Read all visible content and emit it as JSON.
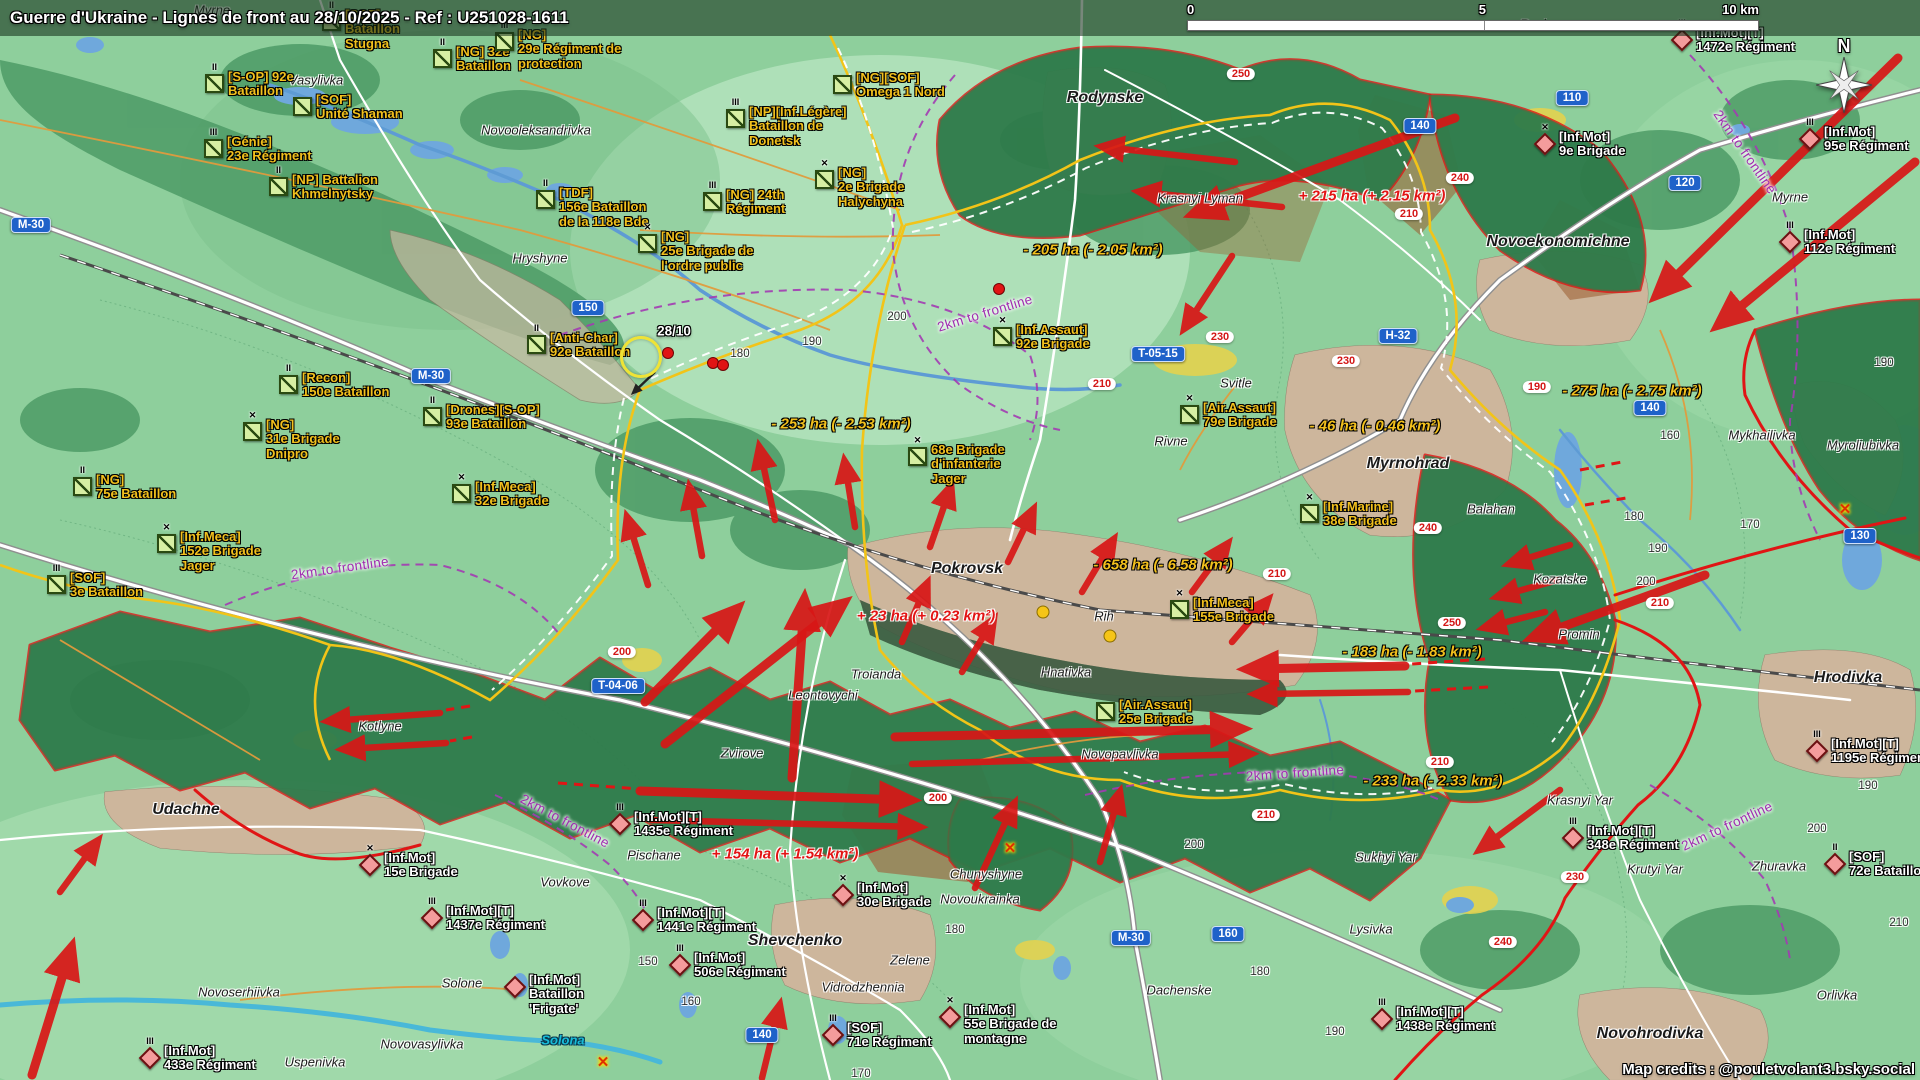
{
  "header": {
    "title": "Guerre d'Ukraine - Lignes de front au 28/10/2025 - Ref : U251028-1611"
  },
  "scalebar": {
    "t0": "0",
    "t5": "5",
    "t10": "10 km"
  },
  "compass": "N",
  "credits": "Map credits : @pouletvolant3.bsky.social",
  "colors": {
    "ua_label": "#f2c01d",
    "ru_label": "#ffffff",
    "front_red": "#e01515",
    "claim_yellow": "#f2c418",
    "shield_blue": "#1f62c9",
    "route_red": "#d31616",
    "frontline_note": "#a02bb0",
    "water": "#6fa8dc",
    "ru_zone": "#2e7a4a",
    "urban": "#cdb69c",
    "gain": "#e21414",
    "loss": "#f2c01d"
  },
  "date_marker": {
    "x": 674,
    "y": 331,
    "text": "28/10"
  },
  "ua_units": [
    {
      "x": 322,
      "y": 8,
      "ech": "II",
      "lines": [
        "[SOF]",
        "Bataillon",
        "Stugna"
      ]
    },
    {
      "x": 205,
      "y": 70,
      "ech": "II",
      "lines": [
        "[S-OP] 92e",
        "Bataillon"
      ]
    },
    {
      "x": 293,
      "y": 93,
      "ech": "",
      "lines": [
        "[SOF]",
        "Unité Shaman"
      ]
    },
    {
      "x": 204,
      "y": 135,
      "ech": "III",
      "lines": [
        "[Génie]",
        "23e Régiment"
      ]
    },
    {
      "x": 269,
      "y": 173,
      "ech": "II",
      "lines": [
        "[NP] Battalion",
        "Khmelnytsky"
      ]
    },
    {
      "x": 433,
      "y": 45,
      "ech": "II",
      "lines": [
        "[NG] 32e",
        "Bataillon"
      ]
    },
    {
      "x": 495,
      "y": 28,
      "ech": "III",
      "lines": [
        "[NG]",
        "29e Régiment de",
        "protection"
      ]
    },
    {
      "x": 833,
      "y": 71,
      "ech": "",
      "lines": [
        "[NG][SOF]",
        "Omega 1 Nord"
      ]
    },
    {
      "x": 726,
      "y": 105,
      "ech": "III",
      "lines": [
        "[NP][Inf.Légère]",
        "Bataillon de",
        "Donetsk"
      ]
    },
    {
      "x": 536,
      "y": 186,
      "ech": "II",
      "lines": [
        "[TDF]",
        "156e Bataillon",
        "de la 118e Bde"
      ]
    },
    {
      "x": 703,
      "y": 188,
      "ech": "III",
      "lines": [
        "[NG] 24th",
        "Régiment"
      ]
    },
    {
      "x": 815,
      "y": 166,
      "ech": "✕",
      "lines": [
        "[NG]",
        "2e Brigade",
        "Halychyna"
      ]
    },
    {
      "x": 638,
      "y": 230,
      "ech": "✕",
      "lines": [
        "[NG]",
        "25e Brigade de",
        "l'ordre public"
      ]
    },
    {
      "x": 527,
      "y": 331,
      "ech": "II",
      "lines": [
        "[Anti-Char]",
        "92e Bataillon"
      ]
    },
    {
      "x": 279,
      "y": 371,
      "ech": "II",
      "lines": [
        "[Recon]",
        "150e Bataillon"
      ]
    },
    {
      "x": 423,
      "y": 403,
      "ech": "II",
      "lines": [
        "[Drones][S-OP]",
        "93e Bataillon"
      ]
    },
    {
      "x": 243,
      "y": 418,
      "ech": "✕",
      "lines": [
        "[NG]",
        "31e Brigade",
        "Dnipro"
      ]
    },
    {
      "x": 73,
      "y": 473,
      "ech": "II",
      "lines": [
        "[NG]",
        "75e Bataillon"
      ]
    },
    {
      "x": 157,
      "y": 530,
      "ech": "✕",
      "lines": [
        "[Inf.Meca]",
        "152e Brigade",
        "Jager"
      ]
    },
    {
      "x": 47,
      "y": 571,
      "ech": "III",
      "lines": [
        "[SOF]",
        "3e Bataillon"
      ]
    },
    {
      "x": 452,
      "y": 480,
      "ech": "✕",
      "lines": [
        "[Inf.Meca]",
        "32e Brigade"
      ]
    },
    {
      "x": 993,
      "y": 323,
      "ech": "✕",
      "lines": [
        "[Inf.Assaut]",
        "92e Brigade"
      ]
    },
    {
      "x": 1180,
      "y": 401,
      "ech": "✕",
      "lines": [
        "[Air.Assaut]",
        "79e Brigade"
      ]
    },
    {
      "x": 908,
      "y": 443,
      "ech": "✕",
      "lines": [
        "68e Brigade",
        "d'infanterie",
        "Jager"
      ]
    },
    {
      "x": 1170,
      "y": 596,
      "ech": "✕",
      "lines": [
        "[Inf.Meca]",
        "155e Brigade"
      ]
    },
    {
      "x": 1300,
      "y": 500,
      "ech": "✕",
      "lines": [
        "[Inf.Marine]",
        "38e Brigade"
      ]
    },
    {
      "x": 1096,
      "y": 698,
      "ech": "",
      "lines": [
        "[Air.Assaut]",
        "25e Brigade"
      ]
    }
  ],
  "ru_units": [
    {
      "x": 1672,
      "y": 26,
      "ech": "III",
      "lines": [
        "[Inf.Mot][T]",
        "1472e Régiment"
      ]
    },
    {
      "x": 1535,
      "y": 130,
      "ech": "✕",
      "lines": [
        "[Inf.Mot]",
        "9e Brigade"
      ]
    },
    {
      "x": 1800,
      "y": 125,
      "ech": "III",
      "lines": [
        "[Inf.Mot]",
        "95e Régiment"
      ]
    },
    {
      "x": 1780,
      "y": 228,
      "ech": "III",
      "lines": [
        "[Inf.Mot]",
        "112e Régiment"
      ]
    },
    {
      "x": 1807,
      "y": 737,
      "ech": "III",
      "lines": [
        "[Inf.Mot][T]",
        "1195e Régiment"
      ]
    },
    {
      "x": 1563,
      "y": 824,
      "ech": "III",
      "lines": [
        "[Inf.Mot][T]",
        "348e Régiment"
      ]
    },
    {
      "x": 1825,
      "y": 850,
      "ech": "II",
      "lines": [
        "[SOF]",
        "72e Bataillon"
      ]
    },
    {
      "x": 1372,
      "y": 1005,
      "ech": "III",
      "lines": [
        "[Inf.Mot][T]",
        "1438e Régiment"
      ]
    },
    {
      "x": 610,
      "y": 810,
      "ech": "III",
      "lines": [
        "[Inf.Mot][T]",
        "1435e Régiment"
      ]
    },
    {
      "x": 360,
      "y": 851,
      "ech": "✕",
      "lines": [
        "[Inf.Mot]",
        "15e Brigade"
      ]
    },
    {
      "x": 422,
      "y": 904,
      "ech": "III",
      "lines": [
        "[Inf.Mot][T]",
        "1437e Régiment"
      ]
    },
    {
      "x": 633,
      "y": 906,
      "ech": "III",
      "lines": [
        "[Inf.Mot][T]",
        "1441e Régiment"
      ]
    },
    {
      "x": 505,
      "y": 973,
      "ech": "",
      "lines": [
        "[Inf.Mot]",
        "Bataillon",
        "'Frigate'"
      ]
    },
    {
      "x": 670,
      "y": 951,
      "ech": "III",
      "lines": [
        "[Inf.Mot]",
        "506e Régiment"
      ]
    },
    {
      "x": 833,
      "y": 881,
      "ech": "✕",
      "lines": [
        "[Inf.Mot]",
        "30e Brigade"
      ]
    },
    {
      "x": 940,
      "y": 1003,
      "ech": "✕",
      "lines": [
        "[Inf.Mot]",
        "55e Brigade de",
        "montagne"
      ]
    },
    {
      "x": 823,
      "y": 1021,
      "ech": "III",
      "lines": [
        "[SOF]",
        "71e Régiment"
      ]
    },
    {
      "x": 140,
      "y": 1044,
      "ech": "III",
      "lines": [
        "[Inf.Mot]",
        "433e Régiment"
      ]
    }
  ],
  "places": [
    {
      "x": 212,
      "y": 10,
      "text": "Myrne"
    },
    {
      "x": 316,
      "y": 80,
      "text": "Vasylivka"
    },
    {
      "x": 536,
      "y": 130,
      "text": "Novooleksandrivka"
    },
    {
      "x": 540,
      "y": 258,
      "text": "Hryshyne"
    },
    {
      "x": 1105,
      "y": 98,
      "cls": "city",
      "text": "Rodynske"
    },
    {
      "x": 1200,
      "y": 198,
      "text": "Krasnyi Lyman"
    },
    {
      "x": 1540,
      "y": 24,
      "text": "Razine"
    },
    {
      "x": 1558,
      "y": 242,
      "cls": "city",
      "text": "Novoekonomichne"
    },
    {
      "x": 1790,
      "y": 197,
      "text": "Myrne"
    },
    {
      "x": 1236,
      "y": 383,
      "text": "Svitle"
    },
    {
      "x": 1171,
      "y": 441,
      "text": "Rivne"
    },
    {
      "x": 1408,
      "y": 464,
      "cls": "city",
      "text": "Myrnohrad"
    },
    {
      "x": 1491,
      "y": 509,
      "text": "Balahan"
    },
    {
      "x": 1762,
      "y": 435,
      "text": "Mykhailivka"
    },
    {
      "x": 1863,
      "y": 445,
      "text": "Myroliubivka"
    },
    {
      "x": 1560,
      "y": 579,
      "text": "Kozatske"
    },
    {
      "x": 1579,
      "y": 634,
      "text": "Promin"
    },
    {
      "x": 1848,
      "y": 678,
      "cls": "city",
      "text": "Hrodivka"
    },
    {
      "x": 1580,
      "y": 800,
      "text": "Krasnyi Yar"
    },
    {
      "x": 1386,
      "y": 857,
      "text": "Sukhyi Yar"
    },
    {
      "x": 1655,
      "y": 869,
      "text": "Krutyi Yar"
    },
    {
      "x": 1779,
      "y": 866,
      "text": "Zhuravka"
    },
    {
      "x": 1837,
      "y": 995,
      "text": "Orlivka"
    },
    {
      "x": 1371,
      "y": 929,
      "text": "Lysivka"
    },
    {
      "x": 1650,
      "y": 1034,
      "cls": "city",
      "text": "Novohrodivka"
    },
    {
      "x": 967,
      "y": 569,
      "cls": "city",
      "text": "Pokrovsk"
    },
    {
      "x": 1104,
      "y": 616,
      "text": "Rih"
    },
    {
      "x": 1066,
      "y": 672,
      "text": "Hnativka"
    },
    {
      "x": 876,
      "y": 674,
      "text": "Troianda"
    },
    {
      "x": 823,
      "y": 695,
      "text": "Leontovychi"
    },
    {
      "x": 742,
      "y": 753,
      "text": "Zvirove"
    },
    {
      "x": 1120,
      "y": 754,
      "text": "Novopavlivka"
    },
    {
      "x": 380,
      "y": 726,
      "text": "Kotlyne"
    },
    {
      "x": 186,
      "y": 810,
      "cls": "city",
      "text": "Udachne"
    },
    {
      "x": 565,
      "y": 882,
      "text": "Vovkove"
    },
    {
      "x": 654,
      "y": 855,
      "text": "Pischane"
    },
    {
      "x": 795,
      "y": 941,
      "cls": "city",
      "text": "Shevchenko"
    },
    {
      "x": 863,
      "y": 987,
      "text": "Vidrodzhennia"
    },
    {
      "x": 910,
      "y": 960,
      "text": "Zelene"
    },
    {
      "x": 986,
      "y": 874,
      "text": "Chunyshyne"
    },
    {
      "x": 980,
      "y": 899,
      "text": "Novoukrainka"
    },
    {
      "x": 1179,
      "y": 990,
      "text": "Dachenske"
    },
    {
      "x": 239,
      "y": 992,
      "text": "Novoserhiivka"
    },
    {
      "x": 462,
      "y": 983,
      "text": "Solone"
    },
    {
      "x": 422,
      "y": 1044,
      "text": "Novovasylivka"
    },
    {
      "x": 315,
      "y": 1062,
      "text": "Uspenivka"
    },
    {
      "x": 563,
      "y": 1040,
      "cls": "water",
      "text": "Solona"
    }
  ],
  "area_changes": [
    {
      "x": 1372,
      "y": 196,
      "cls": "gain",
      "text": "+ 215 ha (+ 2.15 km²)"
    },
    {
      "x": 1093,
      "y": 250,
      "cls": "loss",
      "text": "- 205 ha (- 2.05 km²)"
    },
    {
      "x": 841,
      "y": 424,
      "cls": "loss",
      "text": "- 253 ha (- 2.53 km²)"
    },
    {
      "x": 1632,
      "y": 391,
      "cls": "loss",
      "text": "- 275 ha (- 2.75 km²)"
    },
    {
      "x": 1375,
      "y": 426,
      "cls": "loss",
      "text": "- 46 ha (- 0.46 km²)"
    },
    {
      "x": 1163,
      "y": 565,
      "cls": "loss",
      "text": "- 658 ha (- 6.58 km²)"
    },
    {
      "x": 926,
      "y": 616,
      "cls": "gain",
      "text": "+ 23 ha (+ 0.23 km²)"
    },
    {
      "x": 1412,
      "y": 652,
      "cls": "loss",
      "text": "- 183 ha (- 1.83 km²)"
    },
    {
      "x": 1433,
      "y": 781,
      "cls": "loss",
      "text": "- 233 ha (- 2.33 km²)"
    },
    {
      "x": 785,
      "y": 854,
      "cls": "gain",
      "text": "+ 154 ha (+ 1.54 km²)"
    }
  ],
  "shields_blue": [
    {
      "x": 31,
      "y": 225,
      "text": "M-30"
    },
    {
      "x": 588,
      "y": 308,
      "text": "150"
    },
    {
      "x": 431,
      "y": 376,
      "text": "M-30"
    },
    {
      "x": 1158,
      "y": 354,
      "text": "T-05-15"
    },
    {
      "x": 1398,
      "y": 336,
      "text": "H-32"
    },
    {
      "x": 1572,
      "y": 98,
      "text": "110"
    },
    {
      "x": 1420,
      "y": 126,
      "text": "140"
    },
    {
      "x": 1685,
      "y": 183,
      "text": "120"
    },
    {
      "x": 1650,
      "y": 408,
      "text": "140"
    },
    {
      "x": 1860,
      "y": 536,
      "text": "130"
    },
    {
      "x": 618,
      "y": 686,
      "text": "T-04-06"
    },
    {
      "x": 762,
      "y": 1035,
      "text": "140"
    },
    {
      "x": 1228,
      "y": 934,
      "text": "160"
    },
    {
      "x": 1131,
      "y": 938,
      "text": "M-30"
    }
  ],
  "shields_red": [
    {
      "x": 1241,
      "y": 74,
      "text": "250"
    },
    {
      "x": 1460,
      "y": 178,
      "text": "240"
    },
    {
      "x": 1409,
      "y": 214,
      "text": "210"
    },
    {
      "x": 1220,
      "y": 337,
      "text": "230"
    },
    {
      "x": 1346,
      "y": 361,
      "text": "230"
    },
    {
      "x": 1102,
      "y": 384,
      "text": "210"
    },
    {
      "x": 1537,
      "y": 387,
      "text": "190"
    },
    {
      "x": 622,
      "y": 652,
      "text": "200"
    },
    {
      "x": 1277,
      "y": 574,
      "text": "210"
    },
    {
      "x": 1428,
      "y": 528,
      "text": "240"
    },
    {
      "x": 1452,
      "y": 623,
      "text": "250"
    },
    {
      "x": 1660,
      "y": 603,
      "text": "210"
    },
    {
      "x": 1440,
      "y": 762,
      "text": "210"
    },
    {
      "x": 1266,
      "y": 815,
      "text": "210"
    },
    {
      "x": 1575,
      "y": 877,
      "text": "230"
    },
    {
      "x": 1503,
      "y": 942,
      "text": "240"
    },
    {
      "x": 938,
      "y": 798,
      "text": "200"
    }
  ],
  "contours": [
    {
      "x": 740,
      "y": 354,
      "text": "180"
    },
    {
      "x": 812,
      "y": 342,
      "text": "190"
    },
    {
      "x": 897,
      "y": 317,
      "text": "200"
    },
    {
      "x": 1670,
      "y": 436,
      "text": "160"
    },
    {
      "x": 1884,
      "y": 363,
      "text": "190"
    },
    {
      "x": 1634,
      "y": 517,
      "text": "180"
    },
    {
      "x": 1658,
      "y": 549,
      "text": "190"
    },
    {
      "x": 1646,
      "y": 582,
      "text": "200"
    },
    {
      "x": 1750,
      "y": 525,
      "text": "170"
    },
    {
      "x": 648,
      "y": 962,
      "text": "150"
    },
    {
      "x": 691,
      "y": 1002,
      "text": "160"
    },
    {
      "x": 861,
      "y": 1074,
      "text": "170"
    },
    {
      "x": 955,
      "y": 930,
      "text": "180"
    },
    {
      "x": 1194,
      "y": 845,
      "text": "200"
    },
    {
      "x": 1260,
      "y": 972,
      "text": "180"
    },
    {
      "x": 1335,
      "y": 1032,
      "text": "190"
    },
    {
      "x": 1868,
      "y": 786,
      "text": "190"
    },
    {
      "x": 1817,
      "y": 829,
      "text": "200"
    },
    {
      "x": 1899,
      "y": 923,
      "text": "210"
    }
  ],
  "front_notes": [
    {
      "x": 985,
      "y": 313,
      "rot": -17,
      "text": "2km to frontline"
    },
    {
      "x": 340,
      "y": 568,
      "rot": -8,
      "text": "2km to frontline"
    },
    {
      "x": 1745,
      "y": 152,
      "rot": 55,
      "text": "2km to frontline"
    },
    {
      "x": 1295,
      "y": 773,
      "rot": -4,
      "text": "2km to frontline"
    },
    {
      "x": 1727,
      "y": 826,
      "rot": -25,
      "text": "2km to frontline"
    },
    {
      "x": 565,
      "y": 821,
      "rot": 28,
      "text": "2km to frontline"
    }
  ],
  "dots_red": [
    {
      "x": 668,
      "y": 353
    },
    {
      "x": 713,
      "y": 363
    },
    {
      "x": 723,
      "y": 365
    },
    {
      "x": 999,
      "y": 289
    }
  ],
  "dots_yellow": [
    {
      "x": 1043,
      "y": 612
    },
    {
      "x": 1110,
      "y": 636
    }
  ],
  "x_marks": [
    {
      "x": 1845,
      "y": 509,
      "sym": "✕"
    },
    {
      "x": 603,
      "y": 1062,
      "sym": "✕"
    },
    {
      "x": 1010,
      "y": 848,
      "sym": "✕"
    }
  ],
  "highlight_circle": {
    "x": 641,
    "y": 357
  },
  "arrows": [
    [
      1235,
      162,
      1105,
      147
    ],
    [
      1282,
      207,
      1142,
      192
    ],
    [
      1455,
      118,
      1198,
      212,
      "big"
    ],
    [
      1232,
      256,
      1186,
      326
    ],
    [
      1898,
      58,
      1660,
      292,
      "big"
    ],
    [
      1915,
      162,
      1722,
      322,
      "big"
    ],
    [
      1570,
      545,
      1512,
      563
    ],
    [
      1558,
      580,
      1500,
      596
    ],
    [
      1545,
      612,
      1487,
      627
    ],
    [
      1705,
      575,
      1537,
      636,
      "big"
    ],
    [
      1560,
      790,
      1482,
      848
    ],
    [
      1405,
      666,
      1252,
      669,
      "big"
    ],
    [
      1408,
      692,
      1258,
      694
    ],
    [
      648,
      585,
      628,
      520
    ],
    [
      702,
      556,
      690,
      490
    ],
    [
      775,
      520,
      760,
      450
    ],
    [
      855,
      527,
      845,
      464
    ],
    [
      930,
      547,
      950,
      489
    ],
    [
      1008,
      562,
      1032,
      512
    ],
    [
      1082,
      592,
      1112,
      542
    ],
    [
      1192,
      592,
      1226,
      546
    ],
    [
      1232,
      642,
      1266,
      602
    ],
    [
      902,
      642,
      926,
      586
    ],
    [
      962,
      672,
      992,
      622
    ],
    [
      645,
      702,
      734,
      612,
      "big"
    ],
    [
      665,
      744,
      840,
      606,
      "big"
    ],
    [
      792,
      778,
      804,
      604,
      "big"
    ],
    [
      895,
      737,
      1237,
      729,
      "big"
    ],
    [
      912,
      764,
      1248,
      754
    ],
    [
      975,
      888,
      1013,
      806
    ],
    [
      1100,
      862,
      1119,
      795
    ],
    [
      440,
      713,
      331,
      721
    ],
    [
      446,
      743,
      346,
      749
    ],
    [
      60,
      892,
      96,
      843
    ],
    [
      32,
      1075,
      70,
      952,
      "big"
    ],
    [
      640,
      791,
      906,
      800,
      "big"
    ],
    [
      652,
      820,
      917,
      827
    ],
    [
      762,
      1078,
      779,
      1008
    ]
  ]
}
